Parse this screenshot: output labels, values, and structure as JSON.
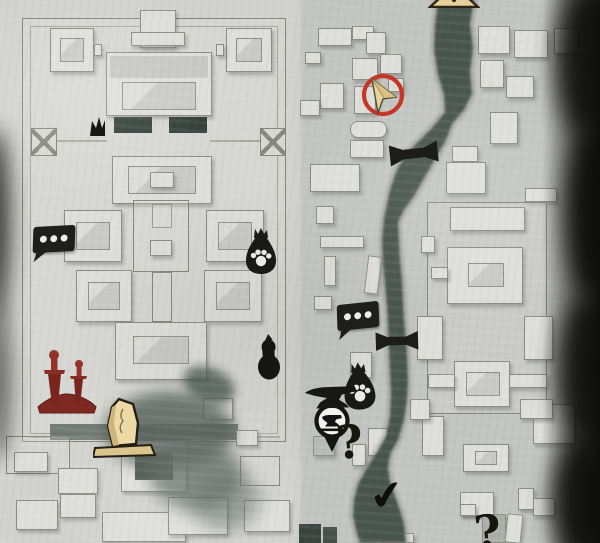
{
  "app": {
    "name": "action-adventure game world map",
    "view": "parchment city map of a walled imperial palace beside a winding river, with quest and shop markers"
  },
  "palette": {
    "parchment_left": "#d2d2ce",
    "parchment_right": "#c3c5c1",
    "building_fill": "#dededb",
    "building_outline": "#83837d",
    "river_green": "#47524c",
    "shadow_green": "#525d56",
    "icon_ink": "#181816",
    "marker_ring_red": "#c53627",
    "arrow_tan": "#e8d3a0",
    "blood_red": "#8a2d25",
    "stele_tan": "#ecd9a6",
    "paw_white": "#e9e9e5"
  },
  "glyphs": {
    "question_mark": "?",
    "checkmark": "✔",
    "dialogue_dots": "●●●"
  },
  "markers": [
    {
      "id": "player",
      "name": "player-position-marker",
      "kind": "tan fold arrow inside red ring",
      "x": 360,
      "y": 72
    },
    {
      "id": "stele-top",
      "name": "stele-marker-clipped",
      "kind": "tan stone marker cut by top edge",
      "x": 428,
      "y": -8
    },
    {
      "id": "crown",
      "name": "small-crown-marker",
      "kind": "small black crown shape",
      "x": 89,
      "y": 116
    },
    {
      "id": "bridge1",
      "name": "bridge-marker",
      "kind": "black bridge crossing river",
      "x": 389,
      "y": 141
    },
    {
      "id": "bubble1",
      "name": "dialogue-marker",
      "kind": "black speech bubble with three dots",
      "x": 33,
      "y": 226
    },
    {
      "id": "bag1",
      "name": "loot-bag-marker",
      "kind": "black tied bag with white paw print",
      "x": 243,
      "y": 228
    },
    {
      "id": "bubble2",
      "name": "dialogue-marker",
      "kind": "black speech bubble with three dots",
      "x": 337,
      "y": 303
    },
    {
      "id": "bridge2",
      "name": "bridge-marker",
      "kind": "black bridge crossing river",
      "x": 374,
      "y": 330
    },
    {
      "id": "gourd",
      "name": "gourd-marker",
      "kind": "black calabash gourd",
      "x": 254,
      "y": 334
    },
    {
      "id": "swords",
      "name": "assassination-marker",
      "kind": "two dark red swords planted in mound",
      "x": 35,
      "y": 347
    },
    {
      "id": "bag2",
      "name": "loot-bag-marker",
      "kind": "black tied bag with white paw print",
      "x": 341,
      "y": 362
    },
    {
      "id": "anvil",
      "name": "blacksmith-anvil-marker",
      "kind": "black anvil",
      "x": 303,
      "y": 384
    },
    {
      "id": "pin",
      "name": "blacksmith-shop-pin",
      "kind": "ringed pin with anvil glyph and pointed tail",
      "x": 309,
      "y": 402
    },
    {
      "id": "stele",
      "name": "stele-marker",
      "kind": "tan standing stone on base",
      "x": 93,
      "y": 396
    },
    {
      "id": "q1",
      "name": "unknown-location-marker",
      "kind": "black question mark",
      "x": 336,
      "y": 419
    },
    {
      "id": "check",
      "name": "completed-objective-marker",
      "kind": "black checkmark",
      "x": 370,
      "y": 476
    },
    {
      "id": "q2",
      "name": "unknown-location-marker-clipped",
      "kind": "question mark cut by bottom edge",
      "x": 474,
      "y": 509
    }
  ]
}
